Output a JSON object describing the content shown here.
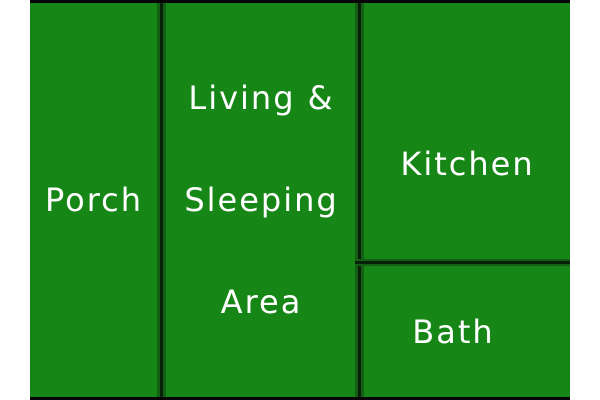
{
  "colors": {
    "room_fill": "#168616",
    "wall_core": "#081f08",
    "wall_shade": "#135f13",
    "outer_border": "#050505",
    "page_background": "#ffffff",
    "label_text": "#ffffff"
  },
  "rooms": {
    "porch": {
      "label": "Porch"
    },
    "living": {
      "line1": "Living &",
      "line2": "Sleeping",
      "line3": "Area"
    },
    "kitchen": {
      "label": "Kitchen"
    },
    "bath": {
      "label": "Bath"
    }
  }
}
